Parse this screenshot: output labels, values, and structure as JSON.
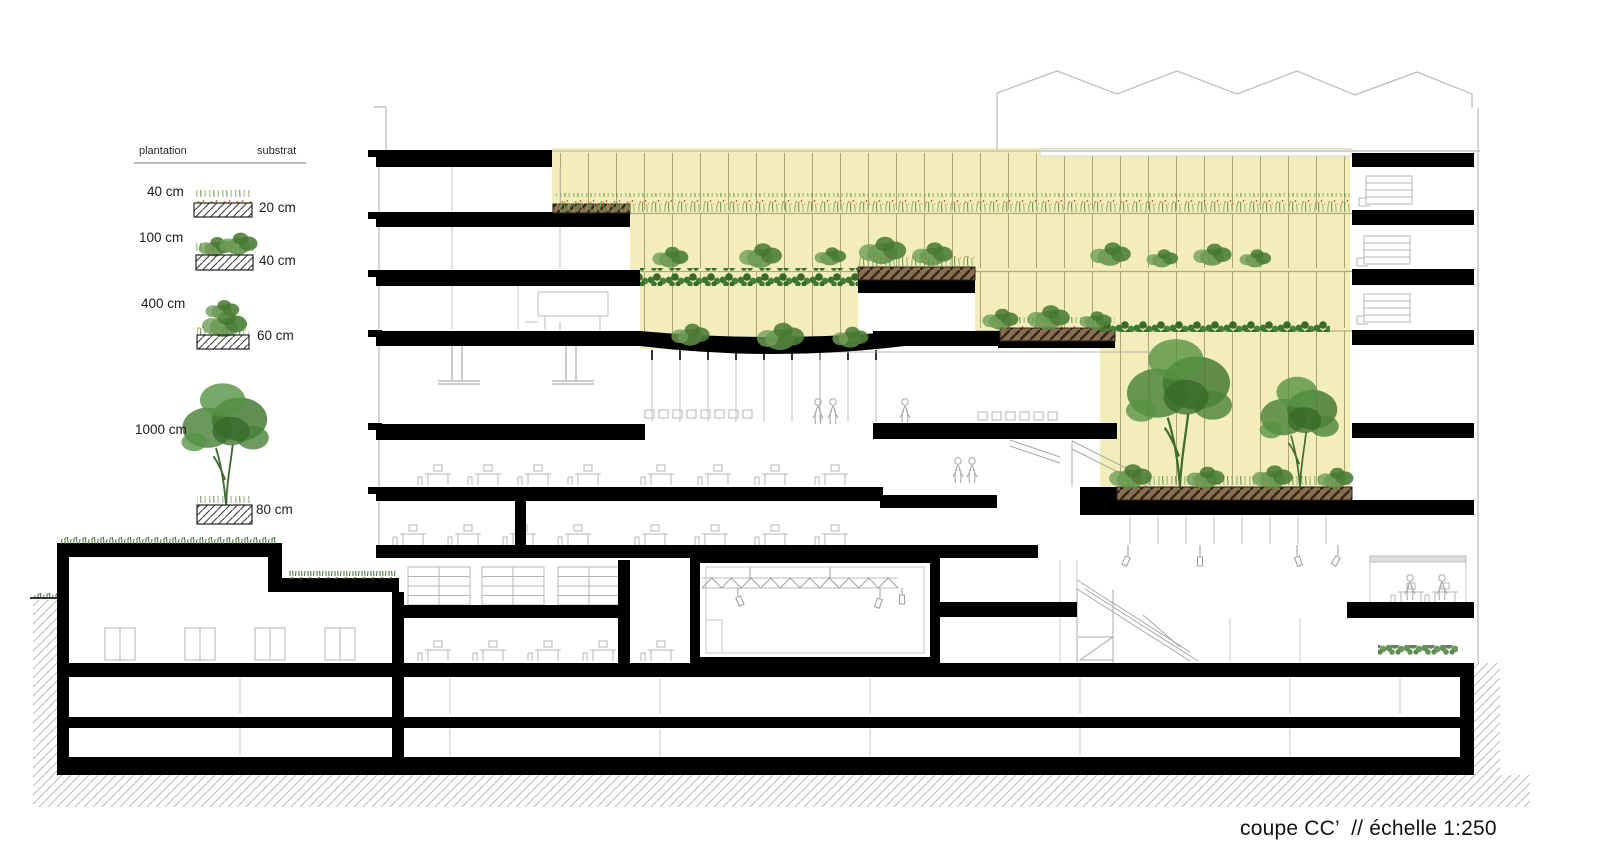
{
  "caption": {
    "text": "coupe CC’  // échelle 1:250"
  },
  "legend": {
    "header": {
      "plantation": "plantation",
      "substrat": "substrat"
    },
    "rows": [
      {
        "plantation_height": "40 cm",
        "substrate_depth": "20 cm",
        "vegetation": "flowering-grass"
      },
      {
        "plantation_height": "100 cm",
        "substrate_depth": "40 cm",
        "vegetation": "small-shrubs"
      },
      {
        "plantation_height": "400 cm",
        "substrate_depth": "60 cm",
        "vegetation": "large-shrub"
      },
      {
        "plantation_height": "1000 cm",
        "substrate_depth": "80 cm",
        "vegetation": "tree"
      }
    ]
  },
  "drawing": {
    "type": "architectural-section",
    "section_name": "coupe CC’",
    "scale": "échelle 1:250",
    "colors": {
      "glazing_highlight": "#f2edbb",
      "structure": "#000000",
      "planter_substrate": "#8a6e50",
      "vegetation_dark": "#3c7630",
      "vegetation_mid": "#5d8f48",
      "detail_lines": "#b5b5b5",
      "ground_hatch": "#adadad"
    }
  }
}
